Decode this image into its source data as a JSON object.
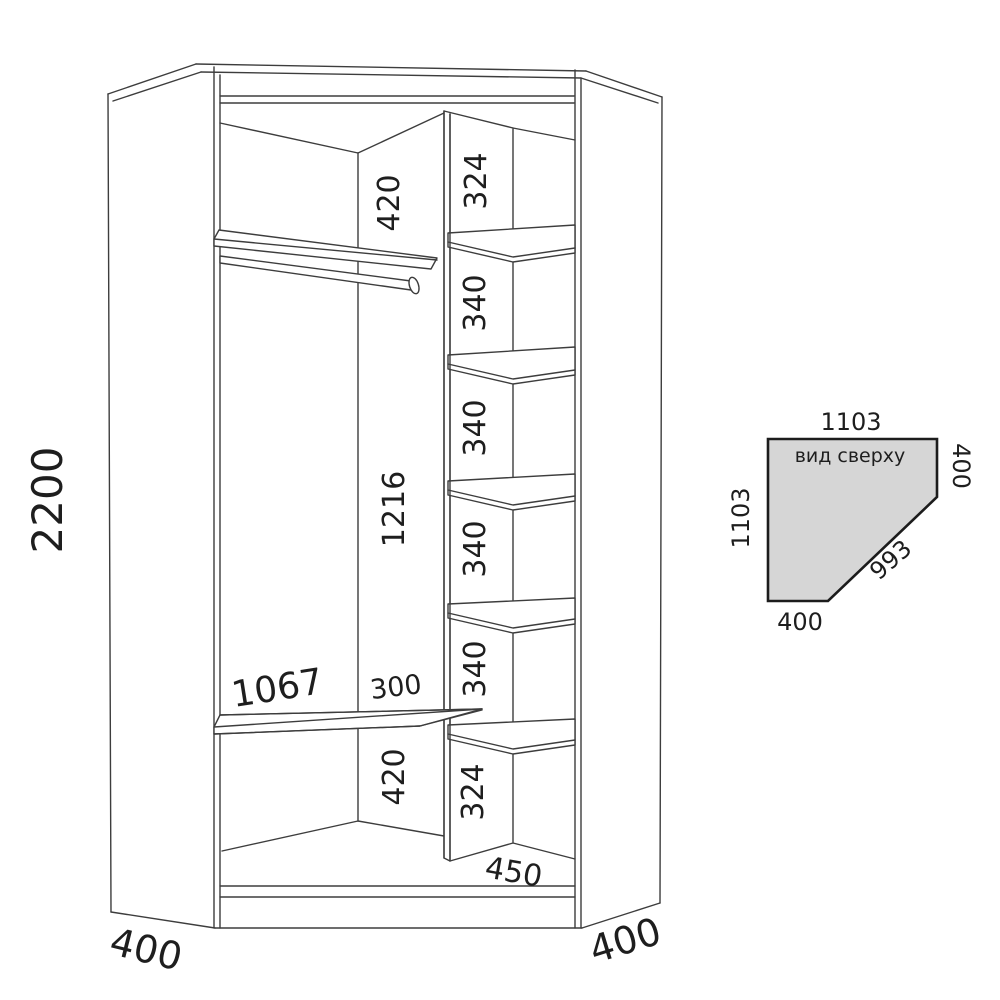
{
  "drawing": {
    "type": "corner wardrobe technical drawing",
    "front_view": {
      "overall_height": "2200",
      "left_side_depth": "400",
      "right_side_depth": "400",
      "left_column": {
        "top_gap": "420",
        "hanging_space": "1216",
        "shelf_length": "1067",
        "shelf_right_gap": "300",
        "bottom_gap": "420"
      },
      "shelf_column": {
        "cells": [
          "324",
          "340",
          "340",
          "340",
          "340",
          "324"
        ],
        "column_width": "450"
      }
    },
    "top_view": {
      "caption": "вид сверху",
      "top_width": "1103",
      "left_depth": "1103",
      "right_side": "400",
      "bottom_side": "400",
      "front_diagonal": "993"
    },
    "colors": {
      "line": "#3d3d3d",
      "text": "#1e1e1e",
      "top_view_fill": "#d6d6d6",
      "background": "#ffffff"
    }
  }
}
